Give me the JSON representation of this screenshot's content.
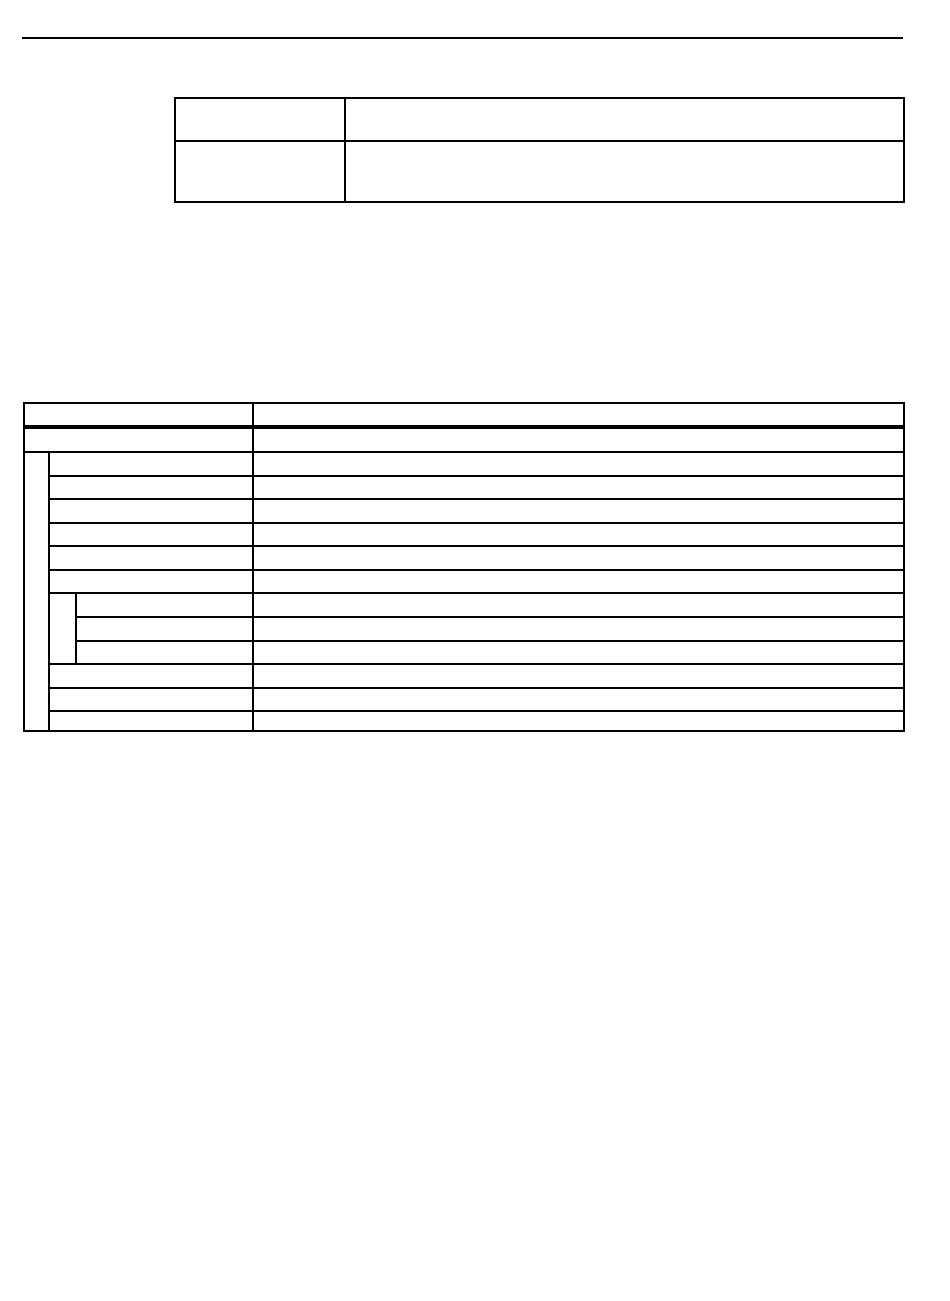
{
  "page": {
    "background_color": "#ffffff",
    "rule_color": "#000000",
    "table_border_color": "#000000"
  },
  "info_table": {
    "rows": [
      {
        "label": "",
        "value": ""
      },
      {
        "label": "",
        "value": ""
      }
    ]
  },
  "main_table": {
    "header_row": {
      "label": "",
      "value": ""
    },
    "intro_row": {
      "label": "",
      "value": ""
    },
    "rows": [
      {
        "level": 1,
        "label": "",
        "value": ""
      },
      {
        "level": 1,
        "label": "",
        "value": ""
      },
      {
        "level": 1,
        "label": "",
        "value": ""
      },
      {
        "level": 1,
        "label": "",
        "value": ""
      },
      {
        "level": 1,
        "label": "",
        "value": ""
      },
      {
        "level": 1,
        "label": "",
        "value": ""
      },
      {
        "level": 2,
        "label": "",
        "value": ""
      },
      {
        "level": 2,
        "label": "",
        "value": ""
      },
      {
        "level": 2,
        "label": "",
        "value": ""
      },
      {
        "level": 1,
        "label": "",
        "value": ""
      },
      {
        "level": 1,
        "label": "",
        "value": ""
      },
      {
        "level": 1,
        "label": "",
        "value": ""
      }
    ]
  }
}
